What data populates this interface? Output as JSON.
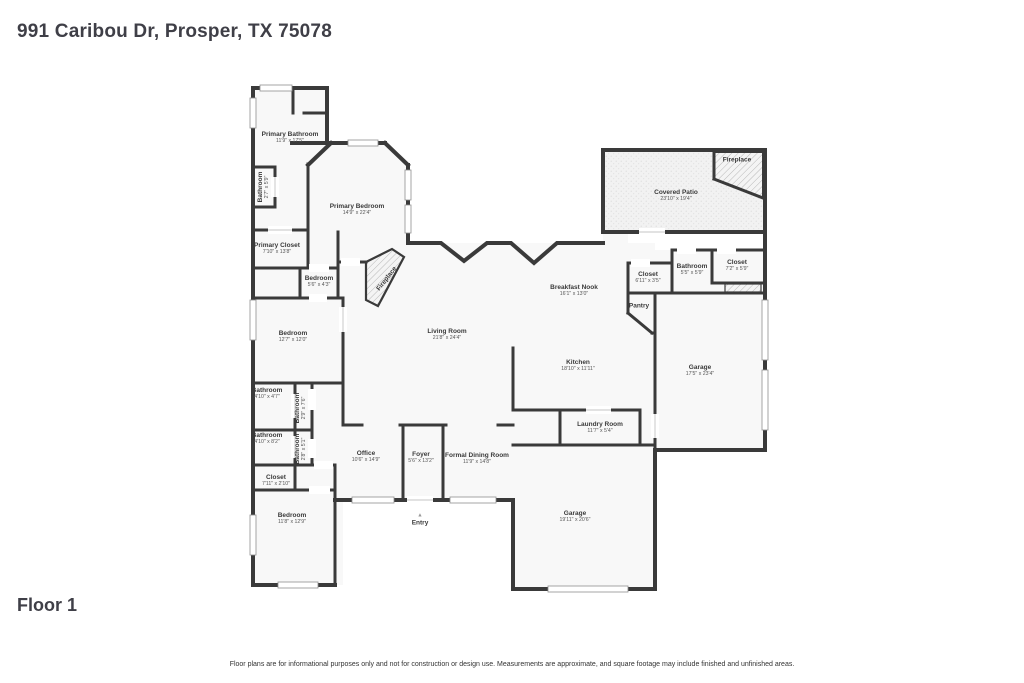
{
  "page": {
    "title": "991 Caribou Dr, Prosper, TX 75078",
    "floor_label": "Floor 1",
    "disclaimer": "Floor plans are for informational purposes only and not for construction or design use. Measurements are approximate, and square footage may include finished and unfinished areas."
  },
  "floor_plan": {
    "wall_color": "#3a3a3a",
    "room_fill": "#f8f8f8",
    "patio_fill": "#f1f1f1",
    "hatch_color": "#bdbdbd",
    "rooms": [
      {
        "name": "Primary Bathroom",
        "dims": "11'9\" x 17'5\"",
        "x": 290,
        "y": 138,
        "rotate": 0
      },
      {
        "name": "Bathroom",
        "dims": "2'7\" x 5'9\"",
        "x": 264,
        "y": 187,
        "rotate": -90
      },
      {
        "name": "Primary Bedroom",
        "dims": "14'9\" x 22'4\"",
        "x": 357,
        "y": 210,
        "rotate": 0
      },
      {
        "name": "Primary Closet",
        "dims": "7'10\" x 13'8\"",
        "x": 277,
        "y": 249,
        "rotate": 0
      },
      {
        "name": "Bedroom",
        "dims": "5'6\" x 4'3\"",
        "x": 319,
        "y": 282,
        "rotate": 0
      },
      {
        "name": "Fireplace",
        "dims": "",
        "x": 387,
        "y": 279,
        "rotate": -52
      },
      {
        "name": "Bedroom",
        "dims": "12'7\" x 12'0\"",
        "x": 293,
        "y": 337,
        "rotate": 0
      },
      {
        "name": "Living Room",
        "dims": "21'8\" x 24'4\"",
        "x": 447,
        "y": 335,
        "rotate": 0
      },
      {
        "name": "Breakfast Nook",
        "dims": "16'1\" x 13'0\"",
        "x": 574,
        "y": 291,
        "rotate": 0
      },
      {
        "name": "Covered Patio",
        "dims": "23'10\" x 19'4\"",
        "x": 676,
        "y": 196,
        "rotate": 0
      },
      {
        "name": "Fireplace",
        "dims": "",
        "x": 737,
        "y": 160,
        "rotate": 0
      },
      {
        "name": "Closet",
        "dims": "6'11\" x 3'5\"",
        "x": 648,
        "y": 278,
        "rotate": 0
      },
      {
        "name": "Bathroom",
        "dims": "5'5\" x 5'9\"",
        "x": 692,
        "y": 270,
        "rotate": 0
      },
      {
        "name": "Closet",
        "dims": "7'2\" x 5'9\"",
        "x": 737,
        "y": 266,
        "rotate": 0
      },
      {
        "name": "Pantry",
        "dims": "",
        "x": 639,
        "y": 306,
        "rotate": 0
      },
      {
        "name": "Kitchen",
        "dims": "18'10\" x 11'11\"",
        "x": 578,
        "y": 366,
        "rotate": 0
      },
      {
        "name": "Garage",
        "dims": "17'5\" x 23'4\"",
        "x": 700,
        "y": 371,
        "rotate": 0
      },
      {
        "name": "Laundry Room",
        "dims": "11'7\" x 5'4\"",
        "x": 600,
        "y": 428,
        "rotate": 0
      },
      {
        "name": "Bathroom",
        "dims": "4'10\" x 4'7\"",
        "x": 267,
        "y": 394,
        "rotate": 0
      },
      {
        "name": "Bathroom",
        "dims": "2'9\" x 7'6\"",
        "x": 301,
        "y": 408,
        "rotate": -90
      },
      {
        "name": "Bathroom",
        "dims": "4'10\" x 8'2\"",
        "x": 267,
        "y": 439,
        "rotate": 0
      },
      {
        "name": "Bathroom",
        "dims": "2'8\" x 5'1\"",
        "x": 301,
        "y": 449,
        "rotate": -90
      },
      {
        "name": "Office",
        "dims": "10'6\" x 14'9\"",
        "x": 366,
        "y": 457,
        "rotate": 0
      },
      {
        "name": "Foyer",
        "dims": "5'6\" x 13'2\"",
        "x": 421,
        "y": 458,
        "rotate": 0
      },
      {
        "name": "Formal Dining Room",
        "dims": "11'9\" x 14'8\"",
        "x": 477,
        "y": 459,
        "rotate": 0
      },
      {
        "name": "Closet",
        "dims": "7'11\" x 2'10\"",
        "x": 276,
        "y": 481,
        "rotate": 0
      },
      {
        "name": "Bedroom",
        "dims": "11'8\" x 12'9\"",
        "x": 292,
        "y": 519,
        "rotate": 0
      },
      {
        "name": "Entry",
        "dims": "",
        "x": 420,
        "y": 520,
        "rotate": 0,
        "marker": "▲"
      },
      {
        "name": "Garage",
        "dims": "19'11\" x 20'6\"",
        "x": 575,
        "y": 517,
        "rotate": 0
      }
    ]
  }
}
